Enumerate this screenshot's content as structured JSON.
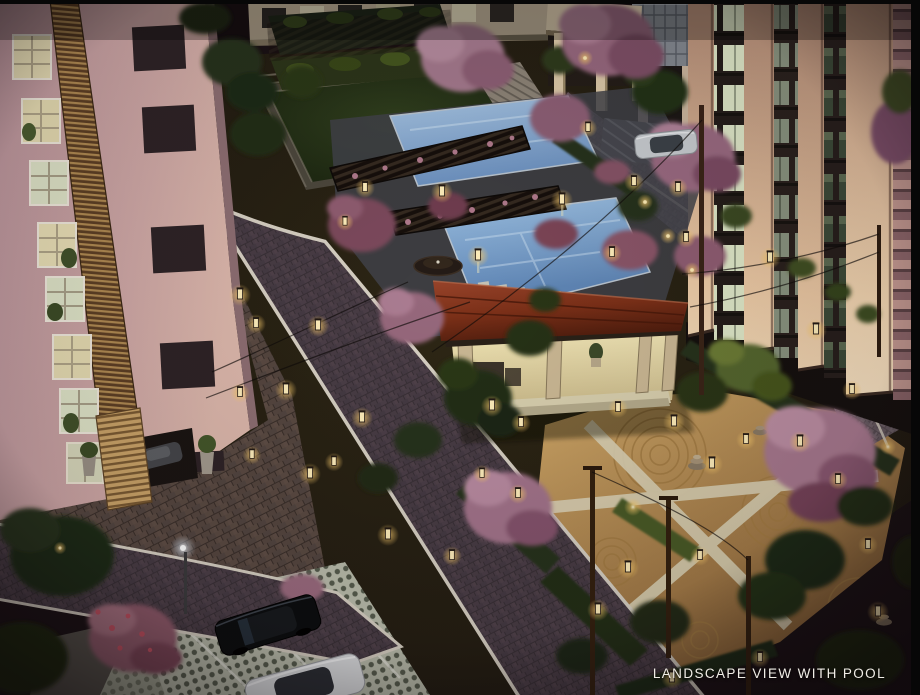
{
  "image": {
    "width": 920,
    "height": 695,
    "type": "3d-architectural-night-render"
  },
  "caption": {
    "text": "LANDSCAPE VIEW WITH POOL"
  },
  "scene": {
    "time_of_day": "night",
    "view": "aerial elevated view of a residential complex landscaped courtyard",
    "landmarks": [
      {
        "id": "left-tower",
        "label": "pink apartment facade with lit windows and wooden louvre band"
      },
      {
        "id": "right-towers",
        "label": "apartment towers with warm illuminated columns and window bays"
      },
      {
        "id": "sunken-lawn",
        "label": "sunken green lawn with terraced steps and vine pergola"
      },
      {
        "id": "swimming-pools",
        "label": "two blue swimming pools crossed by dark pergola bridges"
      },
      {
        "id": "pavilion",
        "label": "clubhouse pavilion with red roof and lit interior"
      },
      {
        "id": "zen-garden",
        "label": "sand garden with raked circles, stone cairns and lantern-lit paths"
      },
      {
        "id": "roads",
        "label": "brick-paved driveways with white kerbs winding through the site"
      },
      {
        "id": "parking",
        "label": "grass-paver parking bay with black and white cars"
      },
      {
        "id": "silver-car",
        "label": "silver car on hatched stall near the towers"
      },
      {
        "id": "trees",
        "label": "flowering pink trees, hedges and garden lanterns"
      }
    ]
  },
  "palette": {
    "background": "#1a1114",
    "road": "#463941",
    "kerb": "#d6cfc2",
    "pool": "#86aed4",
    "roof": "#7c3018",
    "wall_pink": "#cfa8a6",
    "tower_column": "#e3c09c",
    "lantern_glow": "#ffd98a",
    "zen_sand": "#c29a5c",
    "lawn": "#2c3a1d",
    "blossom": "#a4798d",
    "hedge": "#26331c",
    "caption_text": "#f0ede6"
  }
}
